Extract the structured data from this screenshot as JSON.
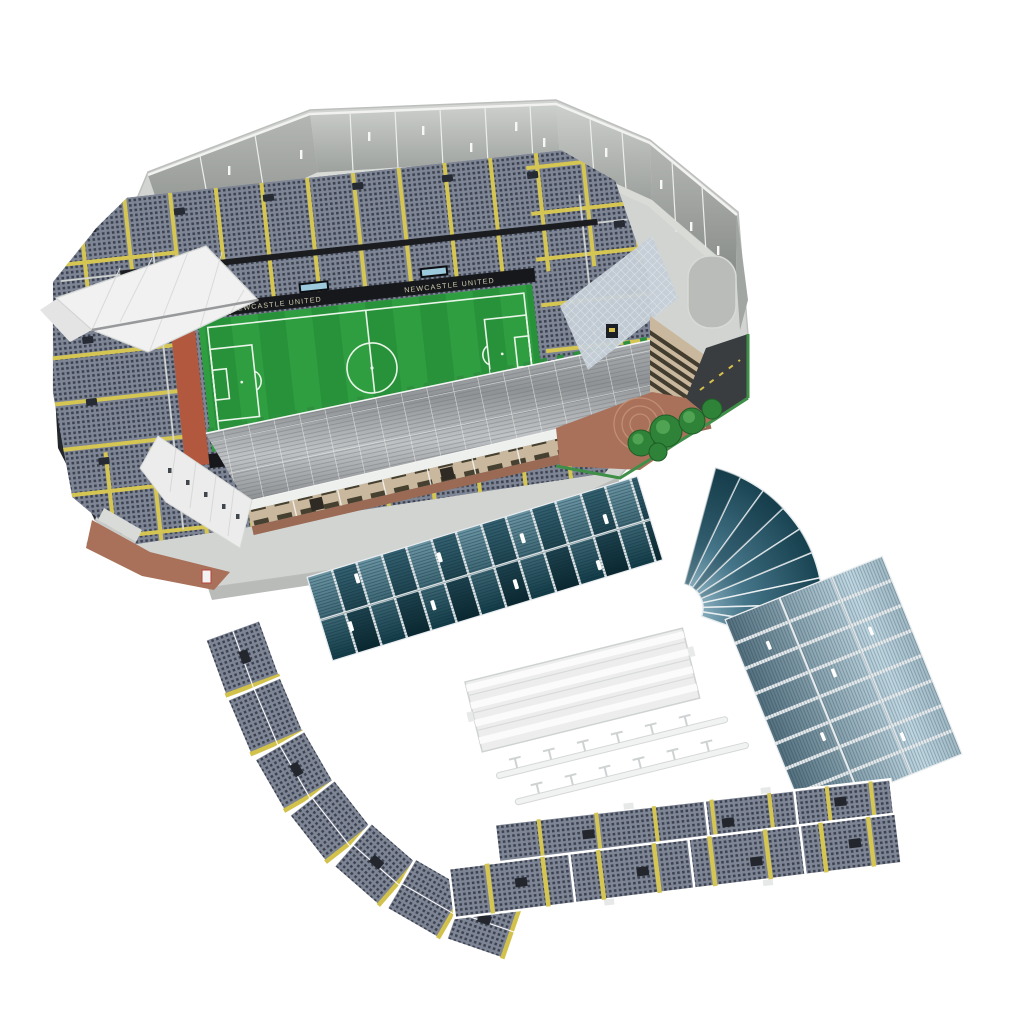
{
  "scene": {
    "background_color": "#ffffff",
    "subject": "Partially assembled 3D jigsaw puzzle model of a football stadium with loose roof sections and seating-tier strips laid out beside it"
  },
  "stadium": {
    "ad_boards": {
      "left_text": "NEWCASTLE UNITED",
      "right_text": "NEWCASTLE UNITED"
    },
    "colors": {
      "pitch_green": "#2f9e41",
      "pitch_stripe_dark": "#28923a",
      "pitch_line": "#eaf5e9",
      "board_black": "#17181b",
      "terracotta": "#b2583e",
      "seat_grey": "#7e8595",
      "seat_dot": "#3c4250",
      "aisle_yellow": "#d5c654",
      "wall_grey": "#c0c3bf",
      "roof_white": "#eff0ef",
      "roof_metal": "#9ba0a3",
      "fascia_tan": "#c9b89d",
      "brick_red": "#9a6a54",
      "plaza_brick": "#a9705a",
      "road_grey": "#3a3d40",
      "road_marking": "#d8c14a",
      "tree_green": "#2f8339",
      "teal_panel": "#10333e",
      "teal_highlight": "#9fc4d4",
      "blue_panel": "#5d7d8e",
      "blue_highlight": "#c0d7e2",
      "scoreboard_blue": "#9cc9dc",
      "piece_edge": "#ffffff"
    }
  },
  "pieces": {
    "list": [
      {
        "id": "assembled-stadium",
        "label": "assembled stadium model"
      },
      {
        "id": "roof-panel-section",
        "label": "L-shaped roof panel section with fanned corner"
      },
      {
        "id": "roof-truss-frame",
        "label": "white corrugated roof panel with truss rails"
      },
      {
        "id": "seating-tier-arc",
        "label": "curved seating tier strip"
      },
      {
        "id": "seating-tier-strip-upper",
        "label": "straight seating tier strip"
      },
      {
        "id": "seating-tier-strip-lower",
        "label": "straight seating tier strip"
      }
    ]
  }
}
